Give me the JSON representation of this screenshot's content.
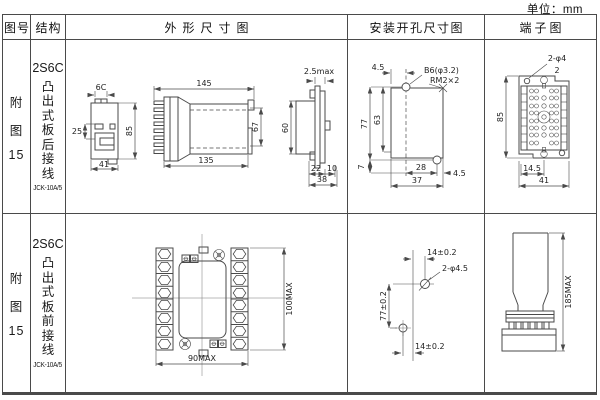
{
  "unit": "单位：mm",
  "headers": {
    "fig": "图号",
    "struct": "结构",
    "outline": "外形尺寸图",
    "mount": "安装开孔尺寸图",
    "term": "端子图"
  },
  "r1": {
    "fig": [
      "附",
      "图",
      "15"
    ],
    "model": "2S6C",
    "desc": "凸出式板后接线",
    "code": "JCK-10A/5",
    "outline": {
      "l6c": "6C",
      "d25": "25",
      "d85": "85",
      "d41": "41",
      "d145": "145",
      "d135": "135",
      "d67": "67",
      "dmax": "2.5max",
      "d60": "60",
      "d22": "22",
      "d10": "10",
      "d38": "38"
    },
    "mount": {
      "d45a": "4.5",
      "hole": "B6(φ3.2)",
      "screw": "RM2×2",
      "d77": "77",
      "d63": "63",
      "d7": "7",
      "d28": "28",
      "d45b": "4.5",
      "d37": "37"
    },
    "term": {
      "holes": "2-φ4",
      "n2": "2",
      "d85": "85",
      "d145": "14.5",
      "d41": "41"
    }
  },
  "r2": {
    "fig": [
      "附",
      "图",
      "15"
    ],
    "model": "2S6C",
    "desc": "凸出式板前接线",
    "code": "JCK-10A/5",
    "outline": {
      "h": "100MAX",
      "w": "90MAX"
    },
    "mount": {
      "t": "14±0.2",
      "holes": "2-φ4.5",
      "v": "77±0.2",
      "b": "14±0.2"
    },
    "term": {
      "h": "185MAX"
    }
  }
}
